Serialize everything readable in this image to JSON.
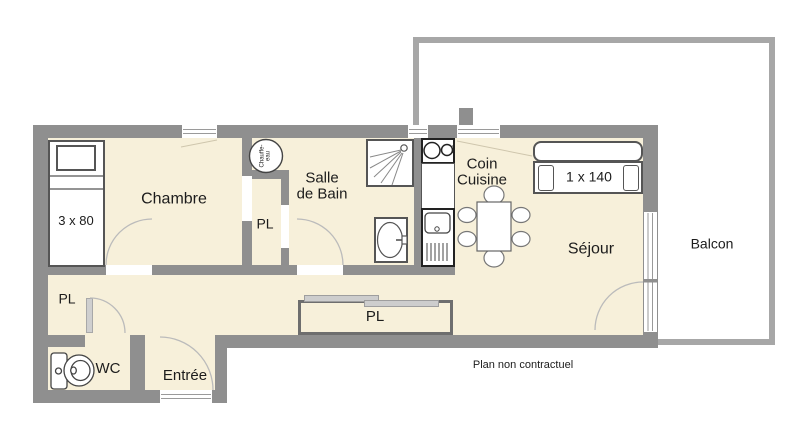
{
  "colors": {
    "wall": "#8f8f8f",
    "balcony_wall": "#a7a7a7",
    "floor": "#f7f0da",
    "fixture_border": "#4a4a4a",
    "door_arc": "#bbbbbb"
  },
  "rooms": {
    "chambre": {
      "label": "Chambre"
    },
    "salle_de_bain": {
      "line1": "Salle",
      "line2": "de Bain"
    },
    "coin_cuisine": {
      "line1": "Coin",
      "line2": "Cuisine"
    },
    "sejour": {
      "label": "Séjour"
    },
    "balcon": {
      "label": "Balcon"
    },
    "wc": {
      "label": "WC"
    },
    "entree": {
      "label": "Entrée"
    },
    "placard": {
      "label": "PL"
    }
  },
  "furniture": {
    "bed_single": {
      "label": "3 x 80"
    },
    "sofa_bed": {
      "label": "1 x 140"
    },
    "water_heater": {
      "line1": "Chauffe-",
      "line2": "eau"
    }
  },
  "footer": {
    "disclaimer": "Plan non contractuel"
  }
}
